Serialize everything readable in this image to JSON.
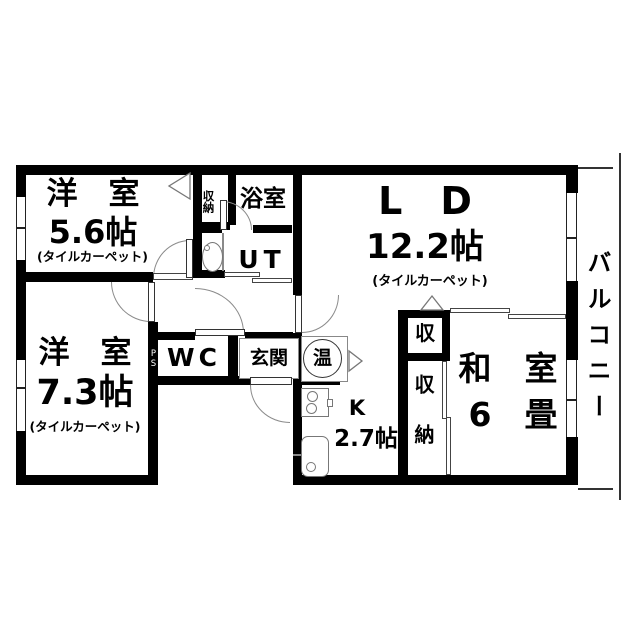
{
  "plan": {
    "colors": {
      "wall": "#000000",
      "fixture_line": "#777777",
      "arc_line": "#8a8a8a",
      "background": "#ffffff"
    },
    "rooms": {
      "western1": {
        "name": "洋　室",
        "size": "5.6帖",
        "floor_note": "(タイルカーペット)"
      },
      "western2": {
        "name": "洋　室",
        "size": "7.3帖",
        "floor_note": "(タイルカーペット)"
      },
      "living_dining": {
        "name": "L　D",
        "size": "12.2帖",
        "floor_note": "(タイルカーペット)"
      },
      "japanese": {
        "name": "和　室",
        "size": "6　畳"
      },
      "kitchen": {
        "name": "K",
        "size": "2.7帖"
      },
      "bath": {
        "name": "浴室"
      },
      "utility": {
        "name": "UT"
      },
      "toilet": {
        "name": "WC"
      },
      "entrance": {
        "name": "玄関"
      },
      "balcony": {
        "name": "バルコニー"
      },
      "closet_hall": {
        "name": "収納"
      },
      "closet_living": {
        "name": "収"
      },
      "closet_japanese": {
        "name": "収納"
      },
      "pipe_space": {
        "name": "PS"
      },
      "water_heater": {
        "name": "温"
      }
    }
  }
}
